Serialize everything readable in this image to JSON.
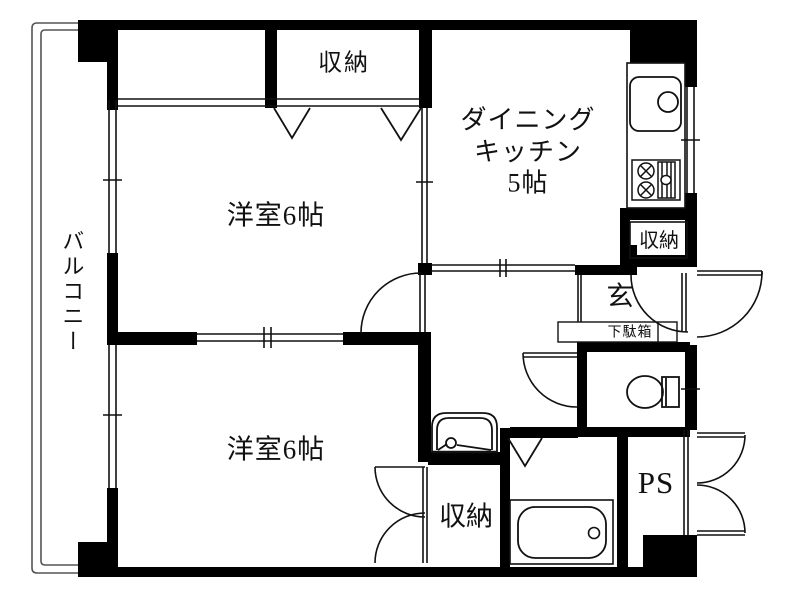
{
  "floorplan": {
    "title": "apartment-floor-plan",
    "rooms": {
      "bedroom1": "洋室6帖",
      "bedroom2": "洋室6帖",
      "dining_kitchen": "ダイニング\nキッチン\n5帖",
      "balcony": "バルコニー",
      "entrance": "玄",
      "shoe_cabinet": "下駄箱",
      "pipe_space": "PS",
      "closet_top": "収納",
      "closet_kitchen": "収納",
      "closet_bottom": "収納"
    },
    "fixtures": [
      "kitchen-sink-icon",
      "gas-stove-icon",
      "toilet-icon",
      "washbasin-icon",
      "bathtub-icon"
    ],
    "colors": {
      "wall": "#000000",
      "line": "#1a1a1a",
      "background": "#ffffff"
    }
  }
}
